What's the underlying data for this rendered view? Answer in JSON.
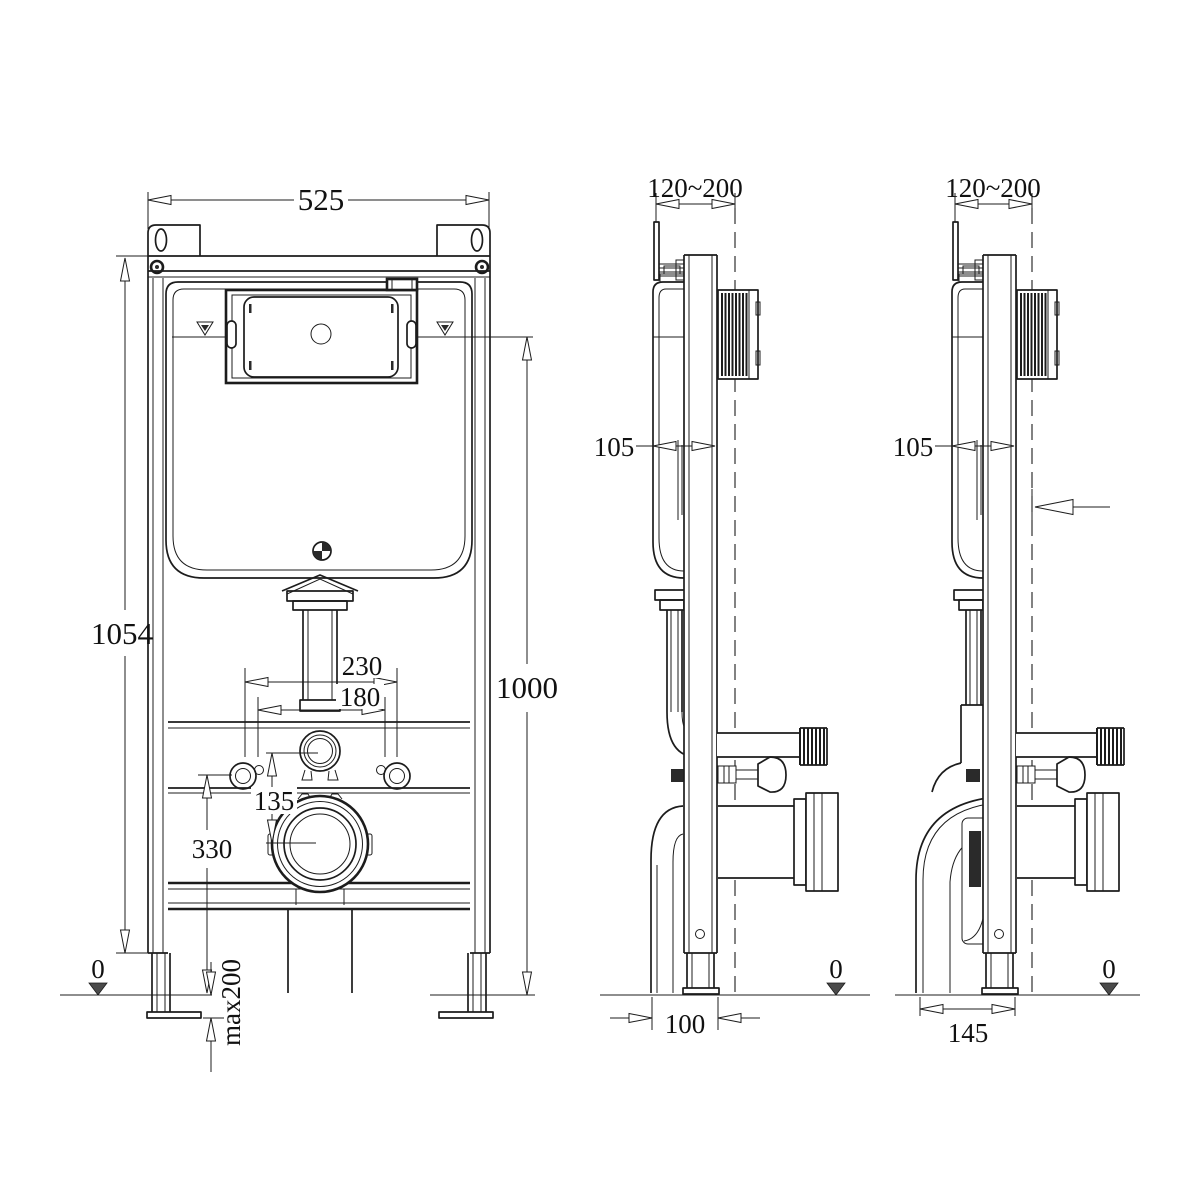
{
  "colors": {
    "line": "#1c1c1c",
    "background": "#ffffff",
    "floor_marker": "#4a4a4a"
  },
  "dims": {
    "front": {
      "width": "525",
      "frame_height": "1054",
      "flush_plate_height": "1000",
      "bolt_spacing": "230",
      "inner_spacing": "180",
      "outlet_offset": "135",
      "bolt_height": "330",
      "floor": "0",
      "leg_adjust": "max200"
    },
    "side_a": {
      "wall_range": "120~200",
      "depth": "105",
      "outlet_depth": "100",
      "floor": "0"
    },
    "side_b": {
      "wall_range": "120~200",
      "depth": "105",
      "outlet_depth": "145",
      "floor": "0"
    }
  }
}
